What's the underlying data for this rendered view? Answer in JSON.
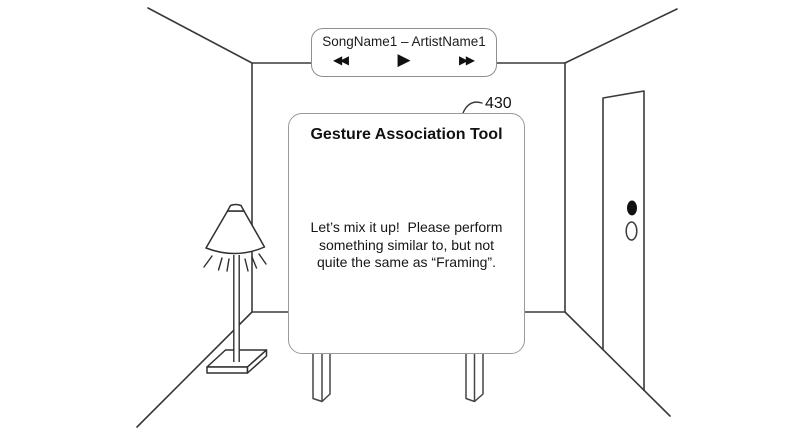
{
  "scene": {
    "figure_label": "430",
    "description": "Room with floor lamp, door, wall-mounted music player and gesture association sign"
  },
  "music_player": {
    "track_label": "SongName1 – ArtistName1",
    "icons": {
      "rewind": "◀◀",
      "play": "▶",
      "fast_forward": "▶▶"
    }
  },
  "sign": {
    "title": "Gesture Association Tool",
    "message_lines": [
      "Let’s mix it up!  Please perform",
      "something similar to, but not",
      "quite the same as “Framing”."
    ]
  },
  "colors": {
    "background": "#ffffff",
    "wall_line": "#3a3a3a",
    "panel_border": "#9a9a9a",
    "text": "#111111",
    "doorknob": "#111111"
  }
}
